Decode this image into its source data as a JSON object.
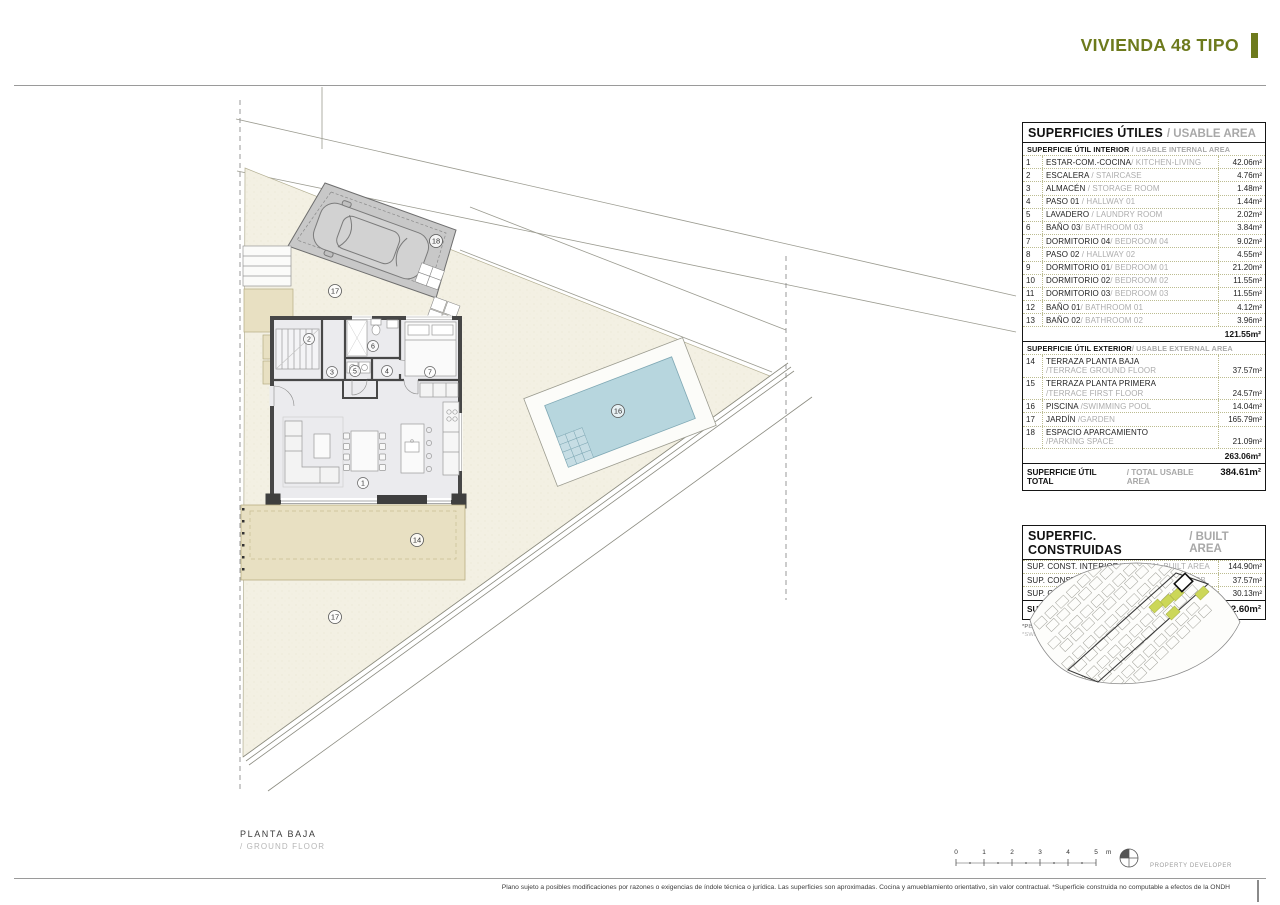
{
  "header": {
    "title": "VIVIENDA 48 TIPO"
  },
  "usable": {
    "title_es": "SUPERFICIES ÚTILES",
    "title_en": "/ USABLE AREA",
    "interior": {
      "label_es": "SUPERFICIE ÚTIL INTERIOR",
      "label_en": " / USABLE INTERNAL AREA",
      "rows": [
        {
          "num": "1",
          "es": "ESTAR-COM.-COCINA",
          "en": "/ KITCHEN-LIVING",
          "value": "42.06m²"
        },
        {
          "num": "2",
          "es": "ESCALERA",
          "en": " / STAIRCASE",
          "value": "4.76m²"
        },
        {
          "num": "3",
          "es": "ALMACÉN",
          "en": " / STORAGE ROOM",
          "value": "1.48m²"
        },
        {
          "num": "4",
          "es": "PASO 01",
          "en": " / HALLWAY 01",
          "value": "1.44m²"
        },
        {
          "num": "5",
          "es": "LAVADERO",
          "en": " / LAUNDRY ROOM",
          "value": "2.02m²"
        },
        {
          "num": "6",
          "es": "BAÑO 03",
          "en": "/ BATHROOM 03",
          "value": "3.84m²"
        },
        {
          "num": "7",
          "es": "DORMITORIO 04",
          "en": "/ BEDROOM 04",
          "value": "9.02m²"
        },
        {
          "num": "8",
          "es": "PASO 02",
          "en": " / HALLWAY 02",
          "value": "4.55m²"
        },
        {
          "num": "9",
          "es": "DORMITORIO 01",
          "en": "/ BEDROOM 01",
          "value": "21.20m²"
        },
        {
          "num": "10",
          "es": "DORMITORIO 02",
          "en": "/ BEDROOM 02",
          "value": "11.55m²"
        },
        {
          "num": "11",
          "es": "DORMITORIO 03",
          "en": "/ BEDROOM 03",
          "value": "11.55m²"
        },
        {
          "num": "12",
          "es": "BAÑO 01",
          "en": "/ BATHROOM 01",
          "value": "4.12m²"
        },
        {
          "num": "13",
          "es": "BAÑO 02",
          "en": "/ BATHROOM 02",
          "value": "3.96m²"
        }
      ],
      "subtotal": "121.55m²"
    },
    "exterior": {
      "label_es": "SUPERFICIE ÚTIL EXTERIOR",
      "label_en": "/ USABLE EXTERNAL AREA",
      "rows": [
        {
          "num": "14",
          "es": "TERRAZA PLANTA BAJA",
          "en": "\n/TERRACE GROUND FLOOR",
          "value": "37.57m²"
        },
        {
          "num": "15",
          "es": "TERRAZA PLANTA PRIMERA",
          "en": "\n/TERRACE FIRST FLOOR",
          "value": "24.57m²"
        },
        {
          "num": "16",
          "es": "PISCINA",
          "en": " /SWIMMING POOL",
          "value": "14.04m²"
        },
        {
          "num": "17",
          "es": "JARDÍN",
          "en": " /GARDEN",
          "value": "165.79m²"
        },
        {
          "num": "18",
          "es": "ESPACIO APARCAMIENTO",
          "en": "\n/PARKING SPACE",
          "value": "21.09m²"
        }
      ],
      "subtotal": "263.06m²"
    },
    "total": {
      "label_es": "SUPERFICIE ÚTIL TOTAL",
      "label_en": "/ TOTAL USABLE AREA",
      "value": "384.61m²"
    }
  },
  "built": {
    "title_es": "SUPERFIC. CONSTRUIDAS",
    "title_en": "/ BUILT AREA",
    "rows": [
      {
        "es": "SUP. CONST. INTERIOR",
        "en": "/INTERNAL BUILT AREA",
        "value": "144.90m²"
      },
      {
        "es": "SUP. CONST. EXTER. PB",
        "en": " /EXT. BUILT AREA PB",
        "value": "37.57m²"
      },
      {
        "es": "SUP. CONST. EXTER. P1",
        "en": " /EXT. BUILT AREA P1",
        "value": "30.13m²"
      }
    ],
    "total": {
      "es": "SUP. CONSTRUIDA TOTAL",
      "en": "/ TOTAL BUILT AREA",
      "value": "212.60m²"
    },
    "footnote_es": "*PISCINA OPCIONAL. Sup. Útil de la lámina de agua 14.04m²",
    "footnote_en": "*SWIMMING POOL OPTIONAL. Usable water surface 14.04m²"
  },
  "plan": {
    "caption_es": "PLANTA BAJA",
    "caption_en": "/ GROUND FLOOR",
    "labels": {
      "living_kitchen": "1",
      "staircase": "2",
      "storage": "3",
      "hallway1": "4",
      "laundry": "5",
      "bathroom3": "6",
      "bedroom4": "7",
      "terrace_gf": "14",
      "pool": "16",
      "garden": "17",
      "parking": "18"
    }
  },
  "scalebar": {
    "ticks": [
      "0",
      "1",
      "2",
      "3",
      "4",
      "5"
    ],
    "unit": "m"
  },
  "footer": {
    "developer": "PROPERTY DEVELOPER",
    "disclaimer": "Plano sujeto a posibles modificaciones por razones o exigencias de índole técnica o jurídica. Las superficies son aproximadas. Cocina y amueblamiento orientativo, sin valor contractual. *Superficie construida no computable a efectos de la ONDH"
  },
  "colors": {
    "accent": "#6d7a1c",
    "table_line": "#bcbc90",
    "plot_fill": "#f3f0e3",
    "terrace_fill": "#e8e0c2",
    "pool_fill": "#b7d6de",
    "parking_fill": "#c8c8c8"
  }
}
